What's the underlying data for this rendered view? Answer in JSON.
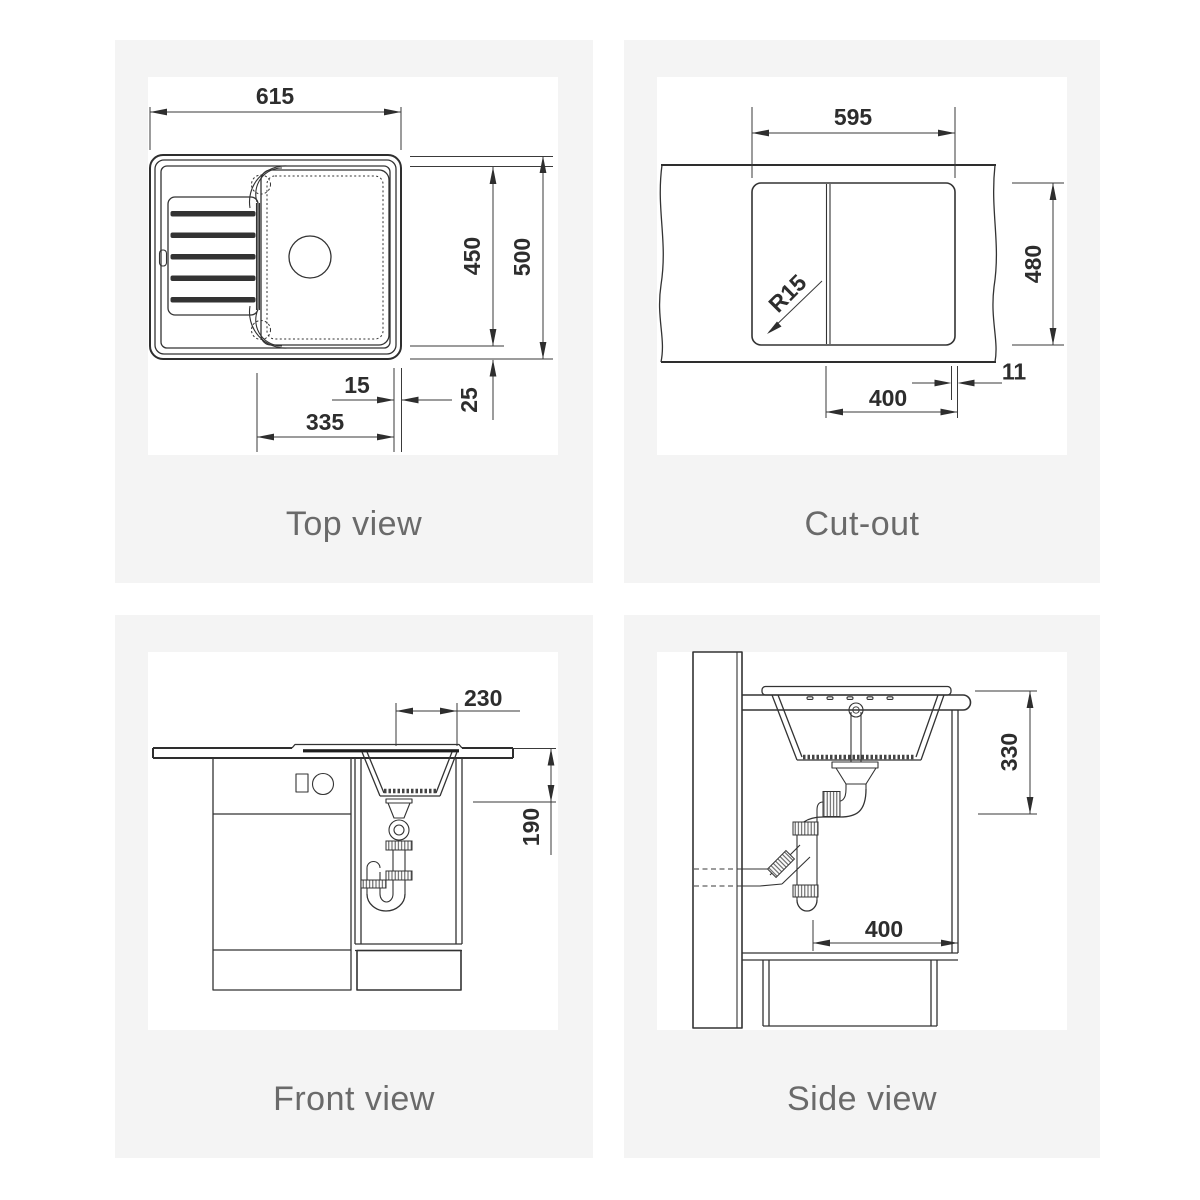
{
  "colors": {
    "page_bg": "#ffffff",
    "panel_bg": "#f4f4f4",
    "drawing_bg": "#ffffff",
    "line": "#333333",
    "dim_text": "#2d2d2d",
    "caption_text": "#6a6a6a"
  },
  "panels": [
    {
      "caption": "Top view",
      "dims": {
        "overall_width": "615",
        "inner_length": "450",
        "overall_length": "500",
        "right_edge_gap": "15",
        "bowl_section_length": "335",
        "rim_inset": "25"
      }
    },
    {
      "caption": "Cut-out",
      "dims": {
        "cutout_width": "595",
        "cutout_depth": "480",
        "corner_radius": "R15",
        "edge_distance": "11",
        "bowl_offset": "400"
      }
    },
    {
      "caption": "Front view",
      "dims": {
        "bowl_width": "230",
        "bowl_depth": "190"
      }
    },
    {
      "caption": "Side view",
      "dims": {
        "mounting_depth": "330",
        "cabinet_clearance": "400"
      }
    }
  ]
}
